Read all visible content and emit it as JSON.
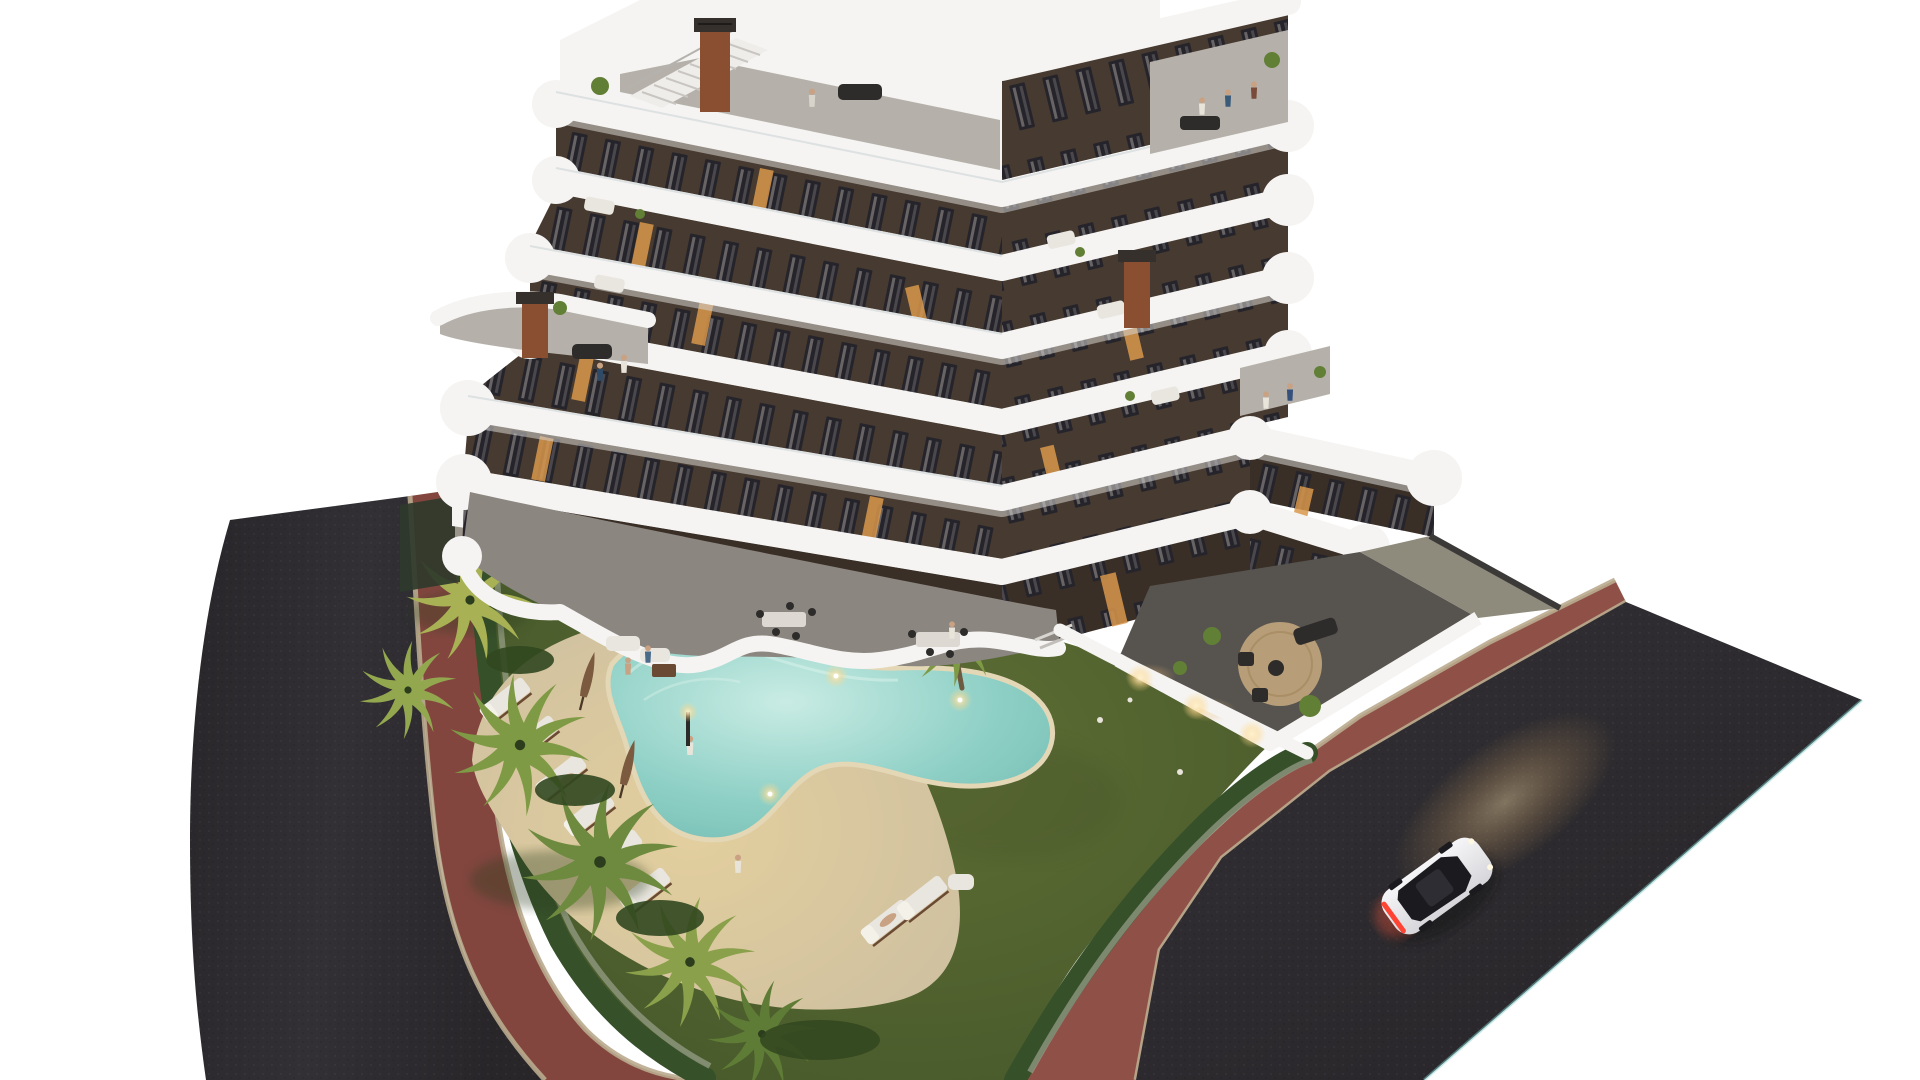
{
  "scene": {
    "type": "architectural-render",
    "setting": "aerial dusk view of a stepped modern apartment building with curved white balcony bands, landscaped garden, free-form pool, palm trees, perimeter roads and a white coupe driving past",
    "counts": {
      "floors_visible": 7,
      "roof_terraces": 4,
      "chimneys": 3,
      "sun_loungers": 8,
      "pool_umbrellas": 2,
      "palm_trees": 9,
      "cars": 1,
      "people_visible": 14
    },
    "objects": [
      "apartment building",
      "rooftop terraces",
      "curved white balconies",
      "swimming pool",
      "pool deck",
      "sun loungers",
      "garden lawn",
      "palm trees",
      "hedges",
      "red sidewalk",
      "asphalt roads",
      "white sports car",
      "corner patio",
      "driveway entrance"
    ],
    "colors": {
      "bg": "#ffffff",
      "asphalt": "#323035",
      "asphalt_dark": "#282629",
      "curb": "#b9ab8e",
      "sidewalk": "#82463f",
      "sidewalk_light": "#8f5047",
      "grass": "#5e6e34",
      "grass_dark": "#44562a",
      "hedge": "#36502a",
      "gravel": "#9aa18c",
      "palm_a": "#a8b154",
      "palm_b": "#7f9a44",
      "palm_c": "#627f36",
      "palm_dark": "#31471f",
      "trunk": "#6e5a40",
      "pool_hi": "#c9ece4",
      "pool_mid": "#8fd0c6",
      "pool_deep": "#6fb9af",
      "coping": "#e3d7b6",
      "deck": "#cdbfa0",
      "deck_lit": "#e3cf9e",
      "facade": "#473a30",
      "facade_dark": "#3a2f27",
      "window": "#26242b",
      "window_lit": "#d9984c",
      "curtain": "#a9a49f",
      "band": "#f5f4f2",
      "band_shadow": "#d6d3d0",
      "deck_roof": "#b5b1aa",
      "terrace": "#8b8680",
      "terrace_dark": "#57544f",
      "corten": "#8a4f30",
      "corten_dark": "#35302c",
      "glass_rail": "#c9d2d6",
      "sofa": "#e9e6df",
      "furn": "#2e2c2a",
      "wood": "#6b4a33",
      "rug": "#c2a67d",
      "umbrella": "#7c5a3f",
      "paving_olive": "#8e8a7c",
      "car": "#ececee",
      "car_glass": "#1b1a1e",
      "tail": "#ff4433",
      "glow": "#ffcf8a",
      "light": "#fff3cf",
      "skin": "#c9a183",
      "teal_edge": "#7fd0cc"
    }
  }
}
